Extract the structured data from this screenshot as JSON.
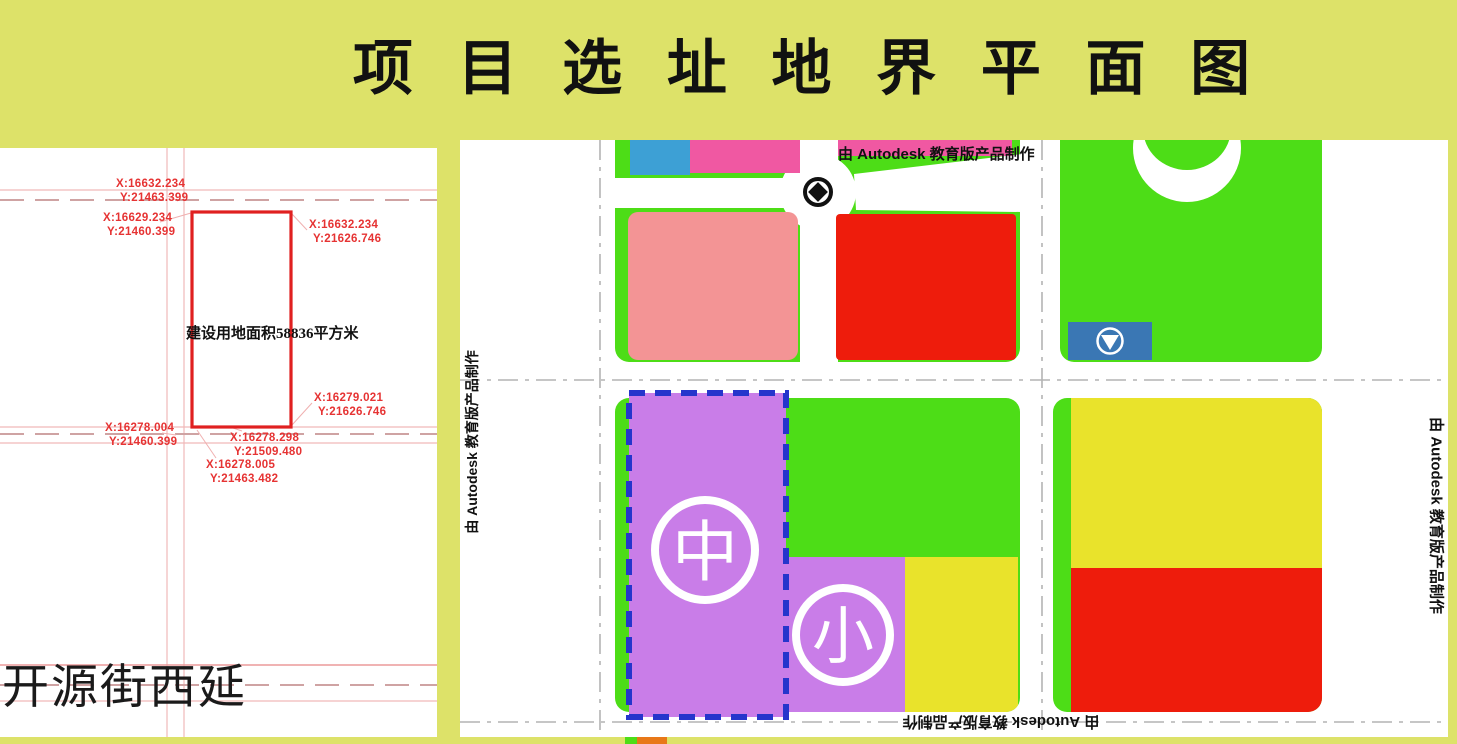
{
  "page": {
    "title": "项 目 选 址 地 界 平 面 图",
    "watermark": "由 Autodesk 教育版产品制作"
  },
  "cad_panel": {
    "area_label": "建设用地面积58836平方米",
    "street_label": "开源街西延",
    "coordinates": [
      {
        "x": "X:16632.234",
        "y": "Y:21463.399"
      },
      {
        "x": "X:16629.234",
        "y": "Y:21460.399"
      },
      {
        "x": "X:16632.234",
        "y": "Y:21626.746"
      },
      {
        "x": "X:16279.021",
        "y": "Y:21626.746"
      },
      {
        "x": "X:16278.004",
        "y": "Y:21460.399"
      },
      {
        "x": "X:16278.298",
        "y": "Y:21509.480"
      },
      {
        "x": "X:16278.005",
        "y": "Y:21463.482"
      }
    ]
  },
  "map_panel": {
    "middle_school_symbol": "中",
    "primary_school_symbol": "小"
  },
  "colors": {
    "page_background": "#dde269",
    "block_green": "#4ddd17",
    "block_magenta": "#f058a2",
    "block_cyan_blue": "#3da0d5",
    "block_salmon": "#f39495",
    "block_red": "#ee1c0c",
    "block_purple": "#c97de8",
    "block_yellow": "#e9e32b",
    "marker_blue": "#3a77b4",
    "site_boundary_red": "#e02020",
    "selection_dash_blue": "#2535cc",
    "strip_orange": "#e87818"
  }
}
